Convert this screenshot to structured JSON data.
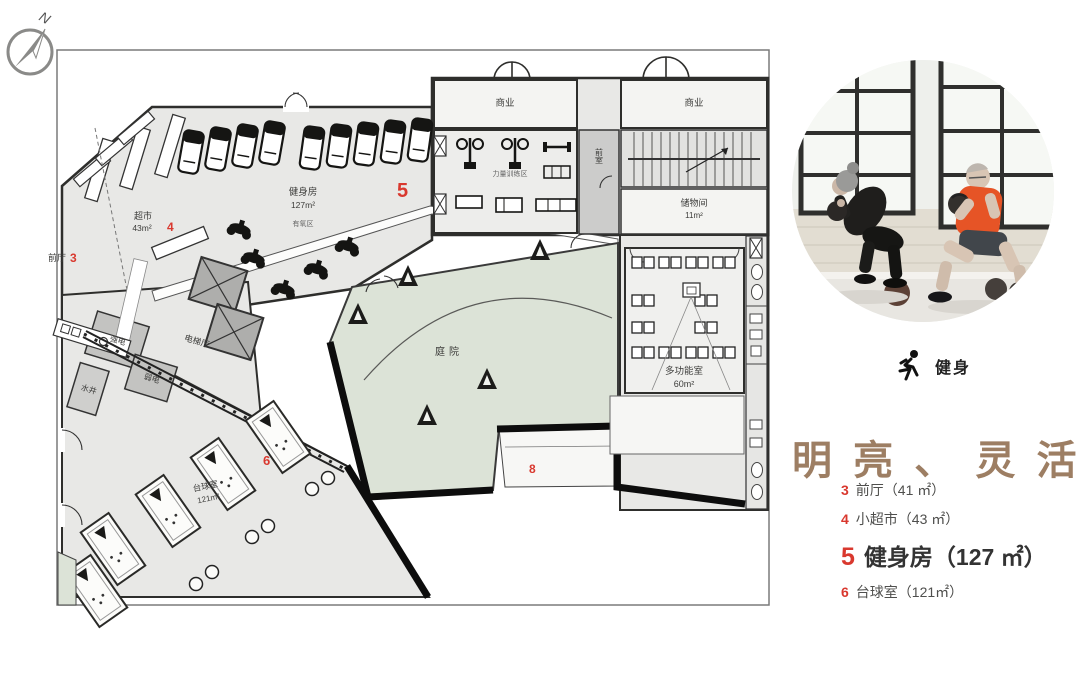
{
  "compass": {
    "north_label": "N"
  },
  "icons": {
    "compass": "compass-north-icon",
    "fitness": "runner-icon"
  },
  "colors": {
    "accent_red": "#d9382e",
    "title_brown": "#9d7e63",
    "courtyard_green": "#dce3d7"
  },
  "plan": {
    "rooms": {
      "front_hall": {
        "name": "前厅",
        "number": "3"
      },
      "supermarket": {
        "name": "超市",
        "area": "43m²",
        "number": "4"
      },
      "gym": {
        "name": "健身房",
        "area": "127m²",
        "zone": "有氧区",
        "number": "5"
      },
      "strength_zone": {
        "name": "力量训练区"
      },
      "commercial_1": {
        "name": "商业"
      },
      "commercial_2": {
        "name": "商业"
      },
      "vestibule": {
        "name": "前室"
      },
      "storage": {
        "name": "储物间",
        "area": "11m²"
      },
      "courtyard": {
        "name": "庭院",
        "number": "8"
      },
      "multifunction": {
        "name": "多功能室",
        "area": "60m²"
      },
      "elevator_hall": {
        "name": "电梯厅"
      },
      "strong_power": {
        "name": "强电"
      },
      "weak_power": {
        "name": "弱电"
      },
      "water_shaft": {
        "name": "水井"
      },
      "billiard": {
        "name": "台球室",
        "area": "121m²",
        "number": "6"
      }
    }
  },
  "sidebar": {
    "tag": {
      "label": "健身"
    },
    "title": {
      "text": "明 亮 、 灵 活",
      "color": "#9d7e63"
    },
    "legend": [
      {
        "num": "3",
        "text": "前厅（41 ㎡）"
      },
      {
        "num": "4",
        "text": "小超市（43 ㎡）"
      },
      {
        "num": "5",
        "text": "健身房（127 ㎡）"
      },
      {
        "num": "6",
        "text": "台球室（121㎡）"
      }
    ]
  }
}
